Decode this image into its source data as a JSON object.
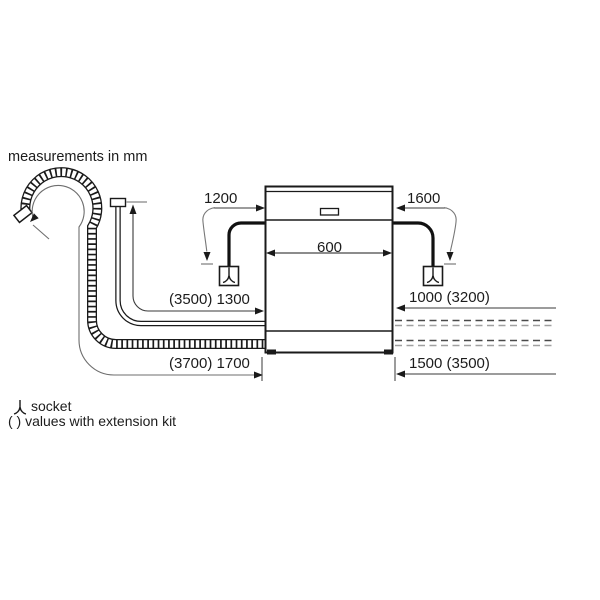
{
  "title": "measurements in mm",
  "diagram": {
    "dims": {
      "top_left": "1200",
      "top_right": "1600",
      "width": "600",
      "supply_hose": "(3500) 1300",
      "right_upper": "1000 (3200)",
      "drain_hose": "(3700) 1700",
      "right_lower": "1500 (3500)"
    },
    "icons": {
      "socket_left": "socket-icon",
      "socket_right": "socket-icon"
    }
  },
  "legend": {
    "socket_label": "socket",
    "extension_note": "( ) values with extension kit"
  },
  "colors": {
    "line": "#1a1a1a",
    "leader": "#777777",
    "tick": "#a8a8a8",
    "dash_dark": "#4a4a4a",
    "dash_light": "#a0a0a0",
    "background": "#ffffff"
  }
}
